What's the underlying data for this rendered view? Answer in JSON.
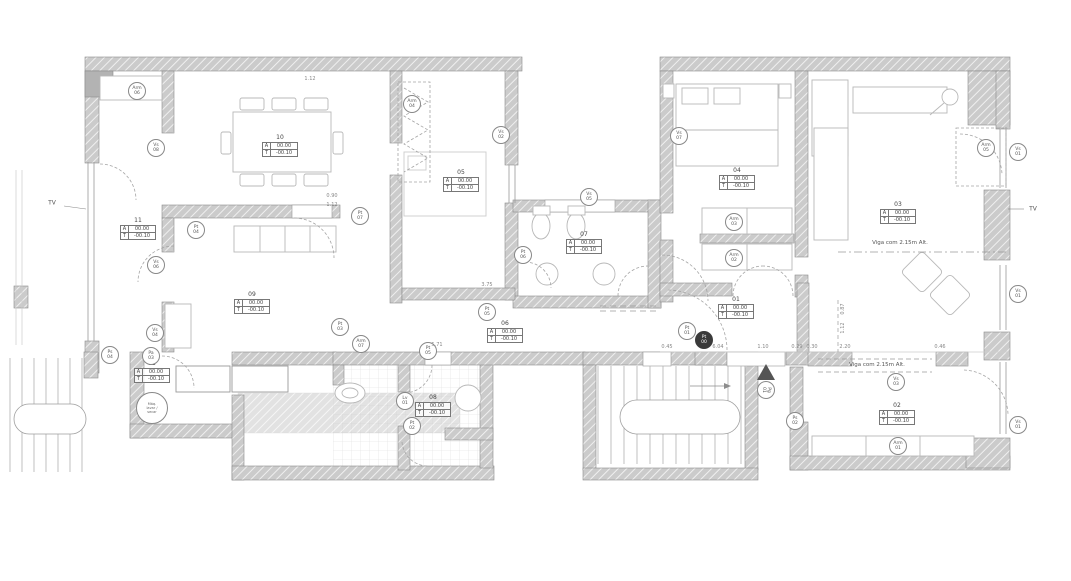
{
  "rooms": [
    {
      "number": "01",
      "a_label": "A",
      "a_value": "00.00",
      "t_label": "T",
      "t_value": "-00.10"
    },
    {
      "number": "02",
      "a_label": "A",
      "a_value": "00.00",
      "t_label": "T",
      "t_value": "-00.10"
    },
    {
      "number": "03",
      "a_label": "A",
      "a_value": "00.00",
      "t_label": "T",
      "t_value": "-00.10"
    },
    {
      "number": "04",
      "a_label": "A",
      "a_value": "00.00",
      "t_label": "T",
      "t_value": "-00.10"
    },
    {
      "number": "05",
      "a_label": "A",
      "a_value": "00.00",
      "t_label": "T",
      "t_value": "-00.10"
    },
    {
      "number": "06",
      "a_label": "A",
      "a_value": "00.00",
      "t_label": "T",
      "t_value": "-00.10"
    },
    {
      "number": "07",
      "a_label": "A",
      "a_value": "00.00",
      "t_label": "T",
      "t_value": "-00.10"
    },
    {
      "number": "08",
      "a_label": "A",
      "a_value": "00.00",
      "t_label": "T",
      "t_value": "-00.10"
    },
    {
      "number": "09",
      "a_label": "A",
      "a_value": "00.00",
      "t_label": "T",
      "t_value": "-00.10"
    },
    {
      "number": "10",
      "a_label": "A",
      "a_value": "00.00",
      "t_label": "T",
      "t_value": "-00.10"
    },
    {
      "number": "11",
      "a_label": "A",
      "a_value": "00.00",
      "t_label": "T",
      "t_value": "-00.10"
    },
    {
      "number": "12",
      "a_label": "A",
      "a_value": "00.00",
      "t_label": "T",
      "t_value": "-00.10"
    }
  ],
  "markers": [
    {
      "type": "Arm",
      "num": "06"
    },
    {
      "type": "Vs",
      "num": "08"
    },
    {
      "type": "Pt",
      "num": "04"
    },
    {
      "type": "Pt",
      "num": "07"
    },
    {
      "type": "Arm",
      "num": "04"
    },
    {
      "type": "Vs",
      "num": "02"
    },
    {
      "type": "Pt",
      "num": "06"
    },
    {
      "type": "Vs",
      "num": "05"
    },
    {
      "type": "Vs",
      "num": "06"
    },
    {
      "type": "Vs",
      "num": "04"
    },
    {
      "type": "Pa",
      "num": "03"
    },
    {
      "type": "Ps",
      "num": "04"
    },
    {
      "type": "Pt",
      "num": "03"
    },
    {
      "type": "Arm",
      "num": "07"
    },
    {
      "type": "Pt",
      "num": "05"
    },
    {
      "type": "Lv",
      "num": "01"
    },
    {
      "type": "Pt",
      "num": "02"
    },
    {
      "type": "Vs",
      "num": "07"
    },
    {
      "type": "Arm",
      "num": "03"
    },
    {
      "type": "Arm",
      "num": "02"
    },
    {
      "type": "Pt",
      "num": "01"
    },
    {
      "type": "Pg",
      "num": "01"
    },
    {
      "type": "Vs",
      "num": "03"
    },
    {
      "type": "Ps",
      "num": "02"
    },
    {
      "type": "Arm",
      "num": "01"
    },
    {
      "type": "Arm",
      "num": "05"
    },
    {
      "type": "Vs",
      "num": "01"
    },
    {
      "type": "Vs",
      "num": "01"
    },
    {
      "type": "Vs",
      "num": "01"
    },
    {
      "type": "Pt",
      "num": "05"
    }
  ],
  "entrance_marker": {
    "type": "Pt",
    "num": "00"
  },
  "washer_marker": {
    "line1": "Máq.",
    "line2": "lavar /",
    "line3": "secar"
  },
  "annotations": {
    "viga_living": "Viga com 2.15m Alt.",
    "viga_bedroom": "Viga com 2.15m Alt.",
    "tv_left": "TV",
    "tv_right": "TV"
  },
  "dims": [
    "1.12",
    "0.90",
    "1.12",
    "3.75",
    "5.71",
    "0.45",
    "6.04",
    "1.10",
    "0.29",
    "0.30",
    "2.20",
    "0.46",
    "0.87",
    "1.12"
  ]
}
